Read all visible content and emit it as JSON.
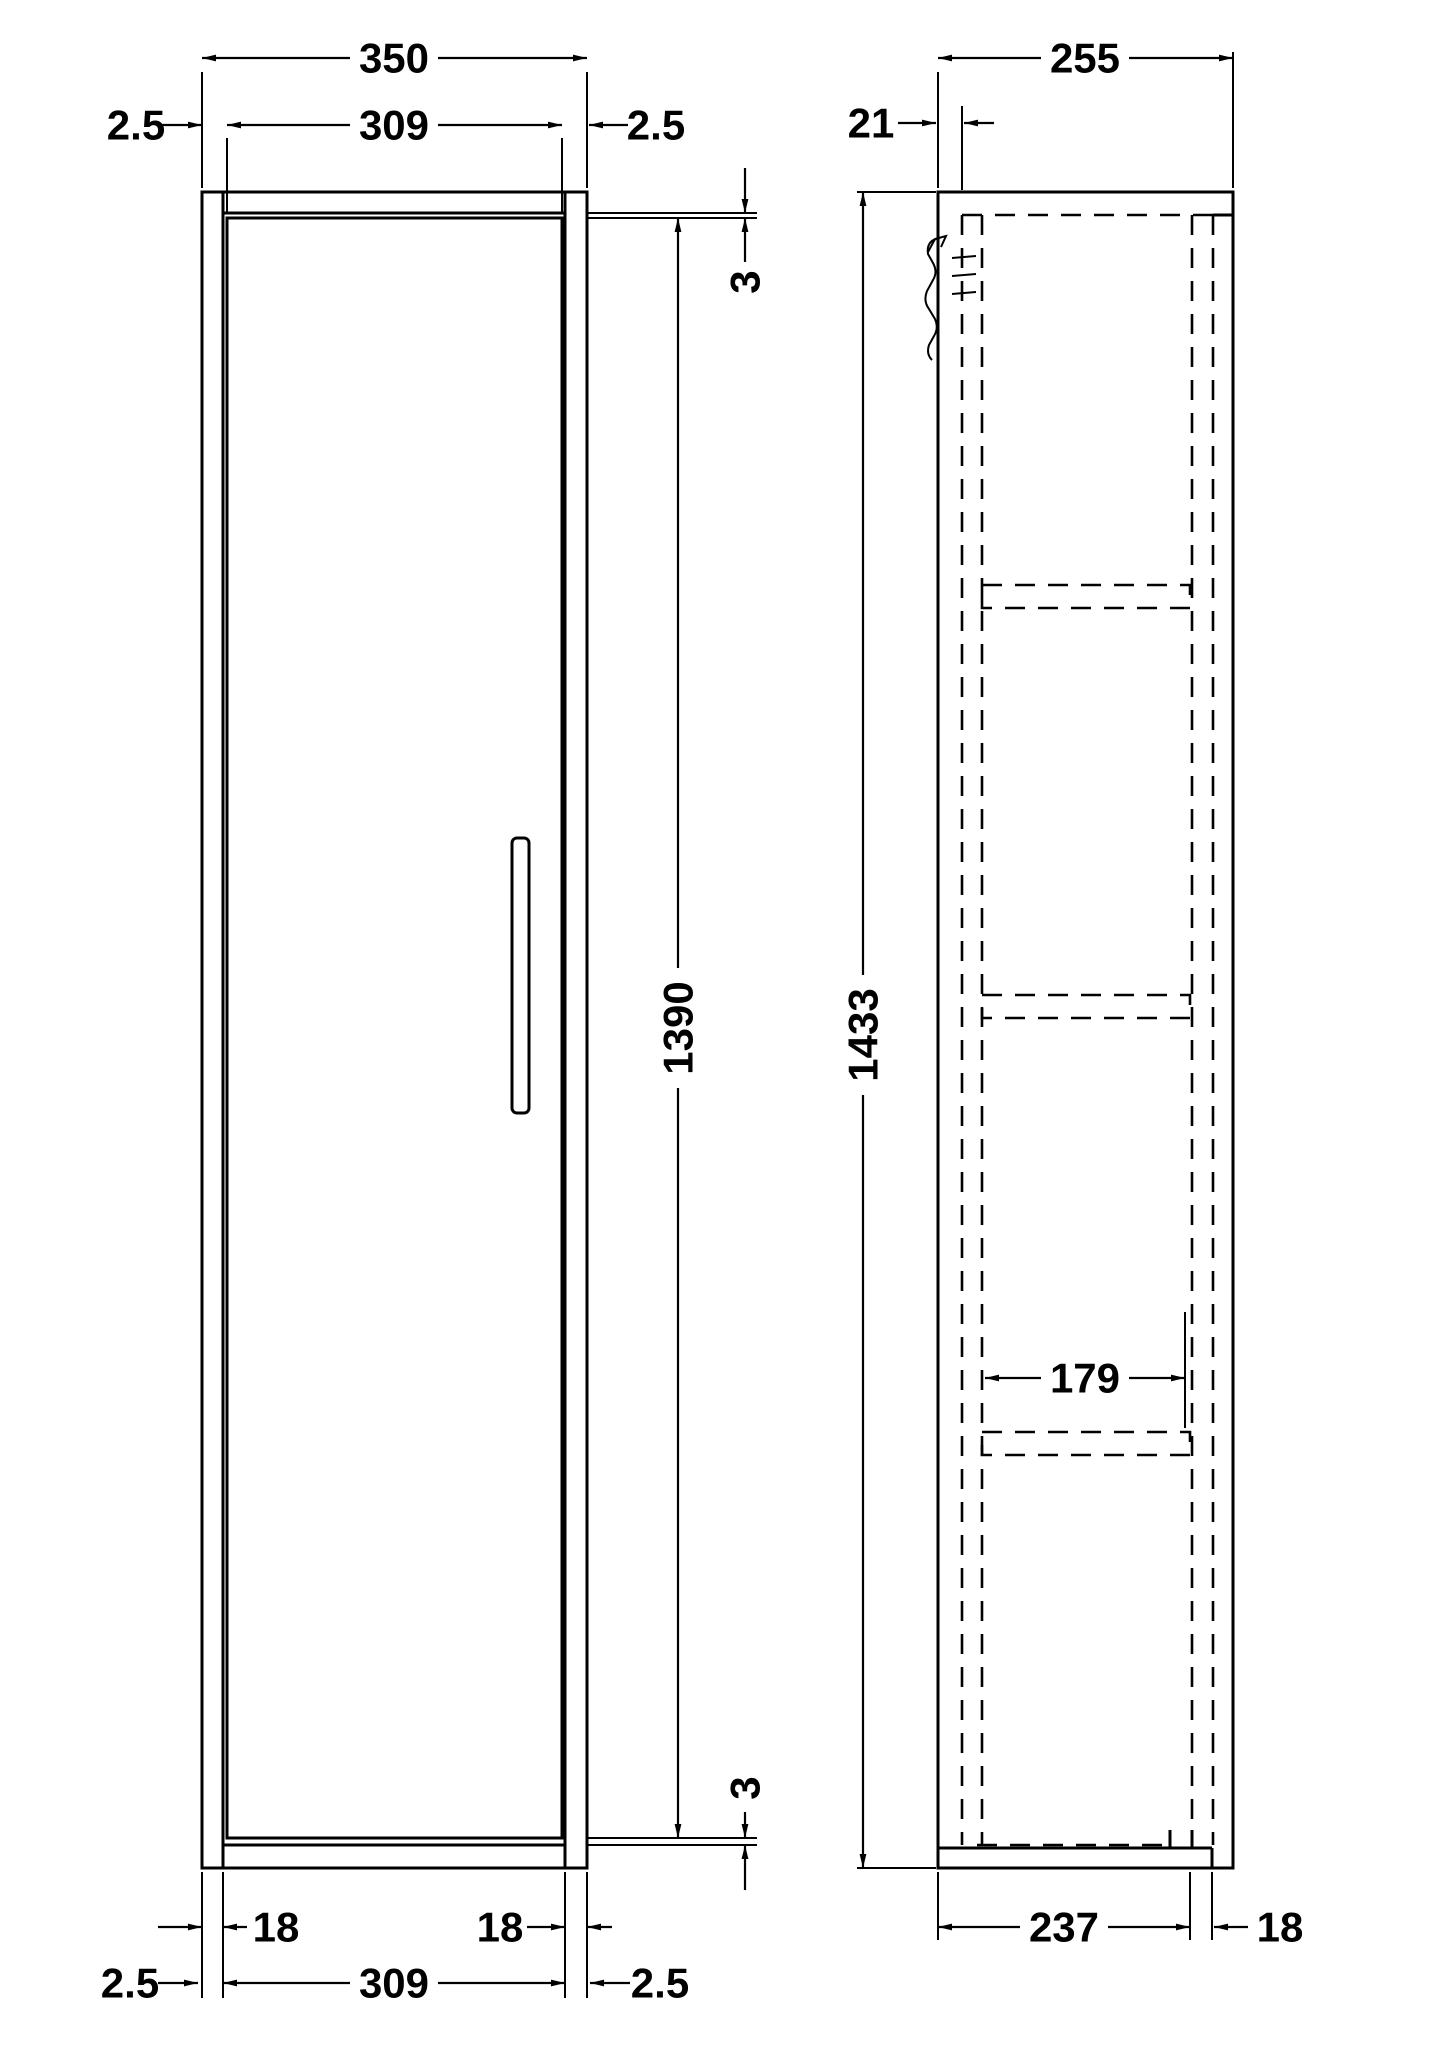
{
  "colors": {
    "ink": "#000000",
    "paper": "#ffffff"
  },
  "front_view": {
    "dim_overall_width": "350",
    "dim_door_width_top": "309",
    "dim_side_gap_top_left": "2.5",
    "dim_side_gap_top_right": "2.5",
    "dim_top_gap": "3",
    "dim_door_height": "1390",
    "dim_bottom_gap": "3",
    "dim_side_panel_left": "18",
    "dim_side_panel_right": "18",
    "dim_door_width_bottom": "309",
    "dim_side_gap_bottom_left": "2.5",
    "dim_side_gap_bottom_right": "2.5"
  },
  "side_view": {
    "dim_overall_depth": "255",
    "dim_door_projection": "21",
    "dim_overall_height": "1433",
    "dim_shelf_depth": "179",
    "dim_carcass_depth": "237",
    "dim_back_inset": "18"
  }
}
